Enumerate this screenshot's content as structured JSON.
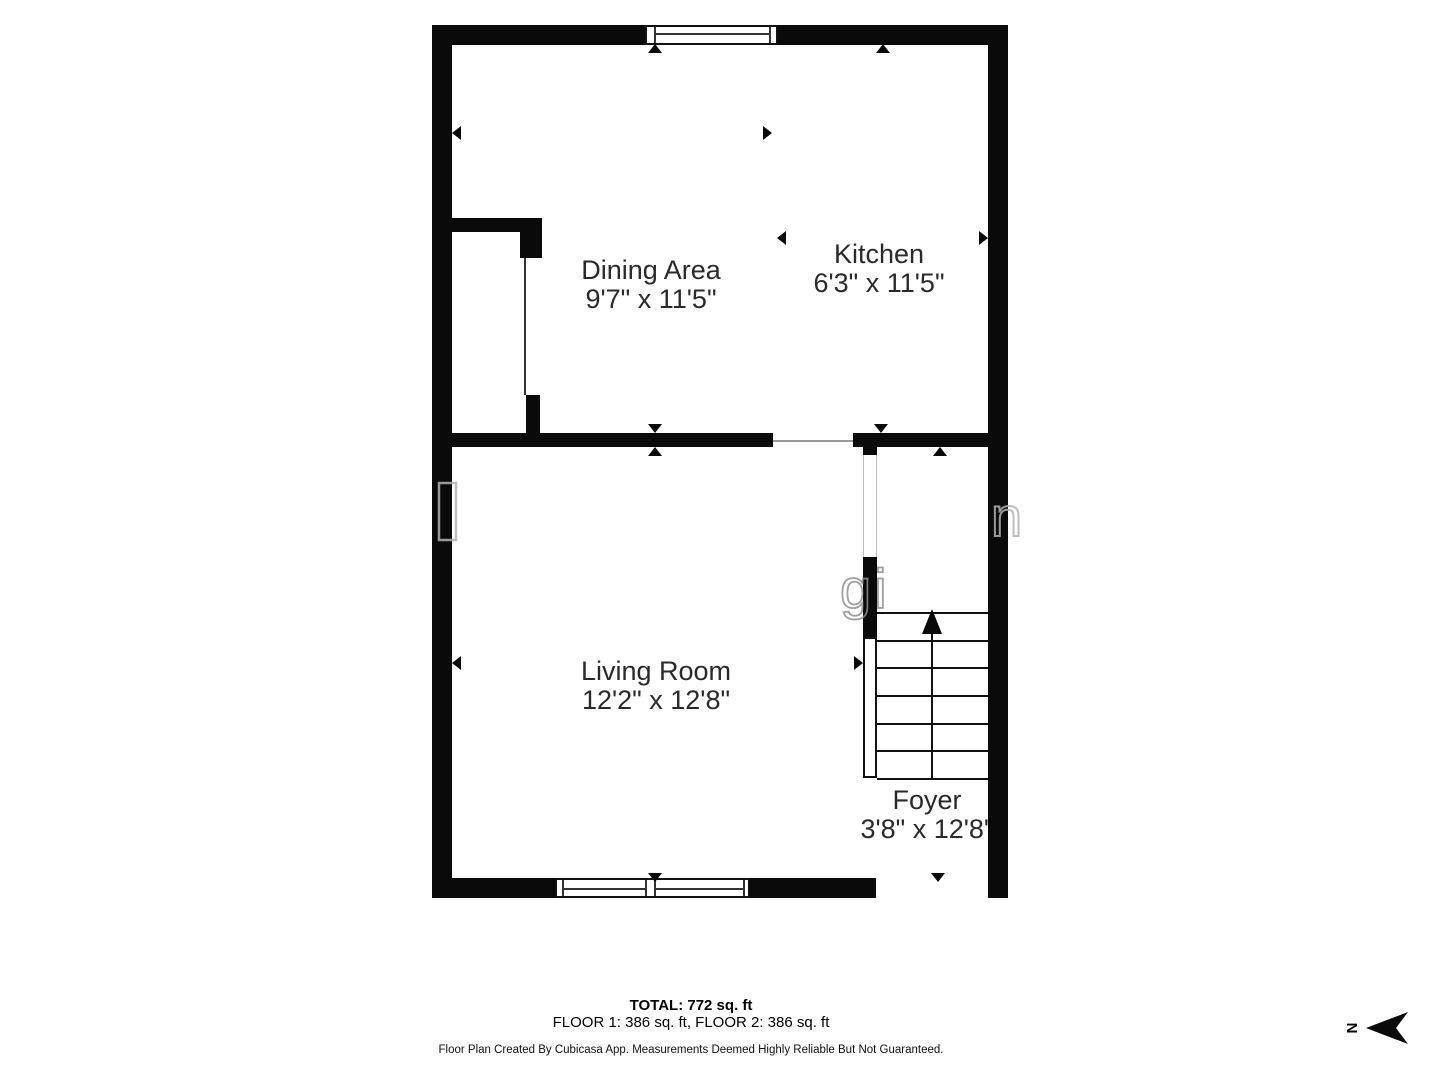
{
  "page": {
    "background": "#ffffff",
    "wall_color": "#0a0a0a"
  },
  "floor_plan": {
    "rooms": [
      {
        "id": "dining",
        "name": "Dining Area",
        "dimensions": "9'7\" x 11'5\""
      },
      {
        "id": "kitchen",
        "name": "Kitchen",
        "dimensions": "6'3\" x 11'5\""
      },
      {
        "id": "living",
        "name": "Living Room",
        "dimensions": "12'2\" x 12'8\""
      },
      {
        "id": "foyer",
        "name": "Foyer",
        "dimensions": "3'8\" x 12'8\""
      }
    ],
    "stairs": {
      "direction": "up"
    }
  },
  "summary": {
    "total": "TOTAL: 772 sq. ft",
    "floors": "FLOOR 1: 386 sq. ft, FLOOR 2: 386 sq. ft",
    "disclaimer": "Floor Plan Created By Cubicasa App. Measurements Deemed Highly Reliable But Not Guaranteed."
  },
  "compass": {
    "label": "N",
    "points": "left"
  },
  "watermark": {
    "fragments": [
      "gi",
      "n"
    ]
  }
}
